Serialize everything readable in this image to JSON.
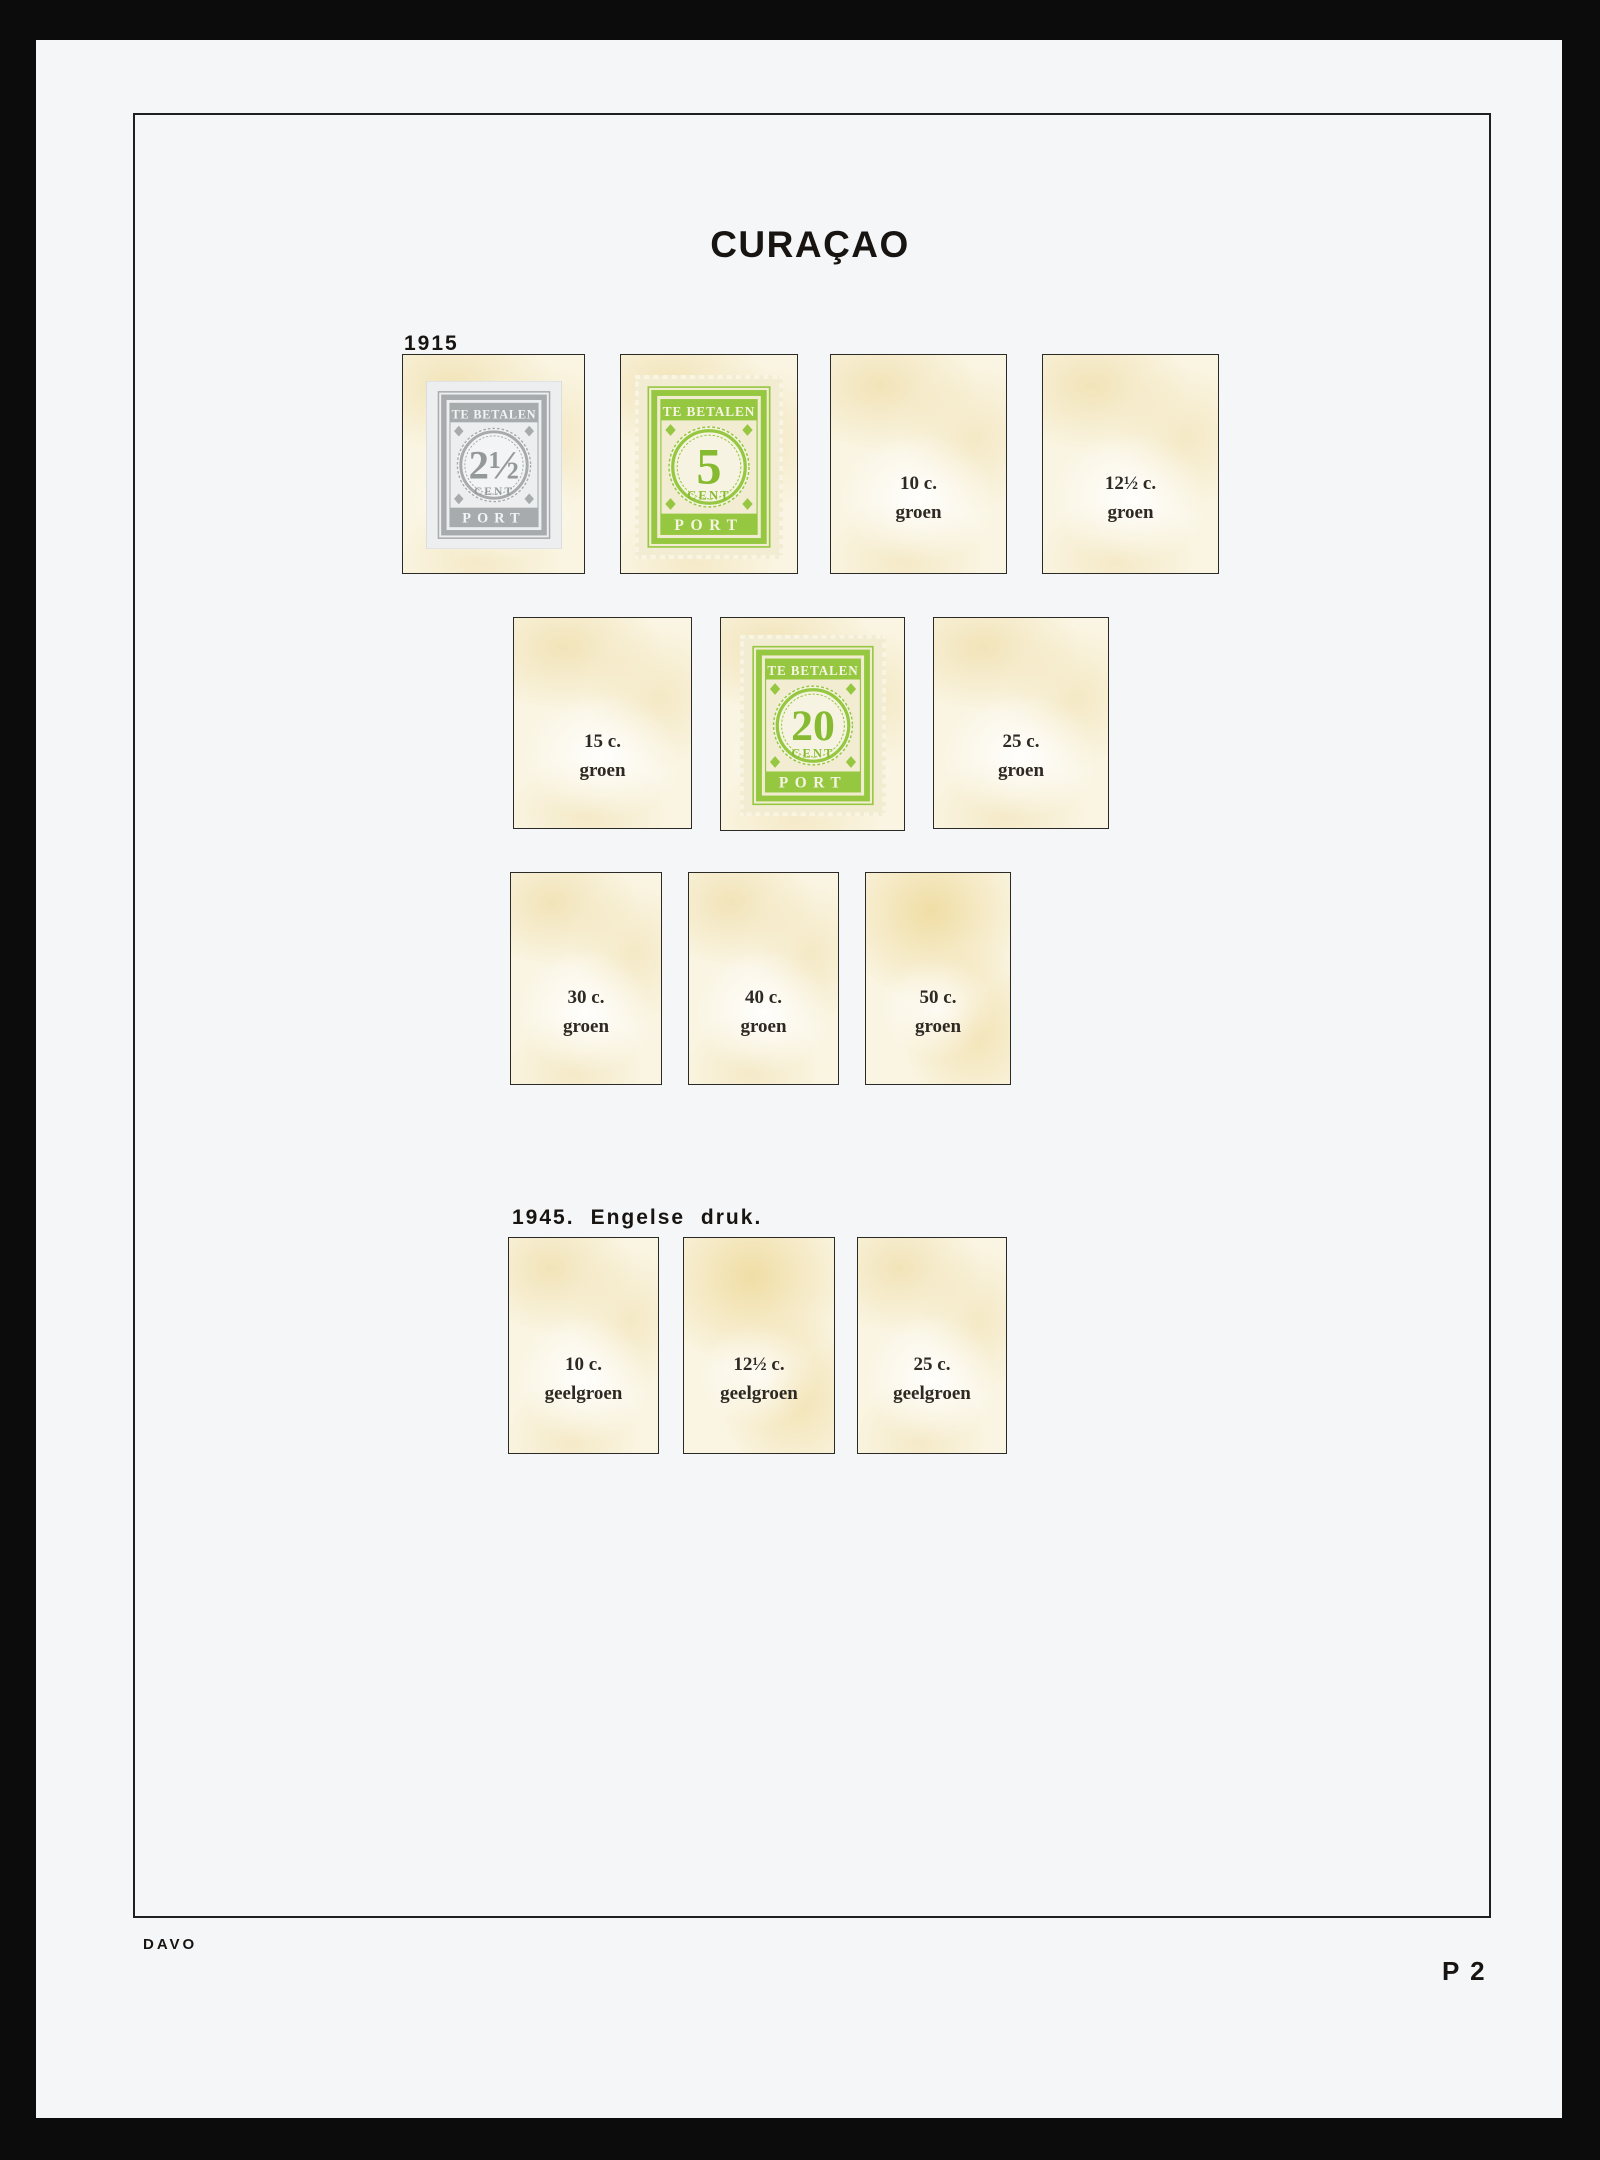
{
  "title": "CURAÇAO",
  "sections": {
    "s1915": {
      "label": "1915",
      "stamps": {
        "grey2h": {
          "top": "TE BETALEN",
          "value": "2½",
          "unit": "CENT",
          "bottom": "PORT",
          "ink_color": "#a7abad"
        },
        "green5": {
          "top": "TE BETALEN",
          "value": "5",
          "unit": "CENT",
          "bottom": "PORT",
          "ink_color": "#95c840"
        },
        "green20": {
          "top": "TE BETALEN",
          "value": "20",
          "unit": "CENT",
          "bottom": "PORT",
          "ink_color": "#95c840"
        }
      },
      "empty_boxes": {
        "c10": {
          "value": "10 c.",
          "shade": "groen"
        },
        "c12h": {
          "value": "12½ c.",
          "shade": "groen"
        },
        "c15": {
          "value": "15 c.",
          "shade": "groen"
        },
        "c25": {
          "value": "25 c.",
          "shade": "groen"
        },
        "c30": {
          "value": "30 c.",
          "shade": "groen"
        },
        "c40": {
          "value": "40 c.",
          "shade": "groen"
        },
        "c50": {
          "value": "50 c.",
          "shade": "groen"
        }
      }
    },
    "s1945": {
      "label_year": "1945.",
      "label_desc": "Engelse druk.",
      "empty_boxes": {
        "c10": {
          "value": "10 c.",
          "shade": "geelgroen"
        },
        "c12h": {
          "value": "12½ c.",
          "shade": "geelgroen"
        },
        "c25": {
          "value": "25 c.",
          "shade": "geelgroen"
        }
      }
    }
  },
  "footer": {
    "publisher": "DAVO",
    "page_code": "P 2"
  },
  "colors": {
    "scan_background": "#0c0c0c",
    "paper_white": "#f5f6f7",
    "frame_line": "#1f1f1f",
    "heading_ink": "#171412",
    "label_ink": "#2e2a23",
    "box_border": "#2b2a27",
    "box_cream": "#faf5e3",
    "green_ink": "#95c840",
    "green_ink_strong": "#86bb31",
    "green_paper": "#f2ecd3",
    "green_paper_light": "#f7f3e2",
    "grey_ink": "#a7abad",
    "grey_ink_strong": "#93989a",
    "grey_paper": "#eceef0",
    "grey_paper_light": "#f3f4f6"
  }
}
